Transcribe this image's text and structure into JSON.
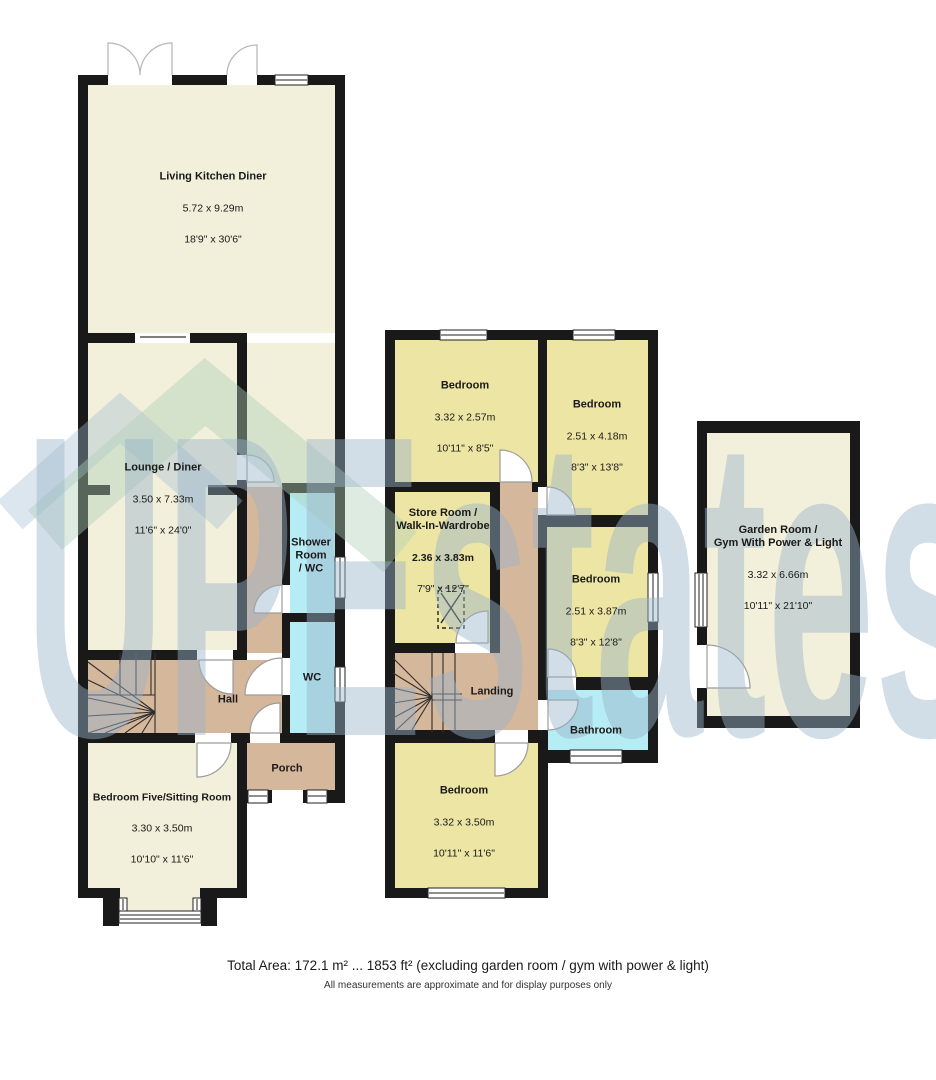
{
  "watermark": {
    "text": "UPEstates"
  },
  "colors": {
    "room_cream": "#f2efda",
    "room_yellow": "#ece5a4",
    "hall_tan": "#d5b79b",
    "wet_cyan": "#b6ecf4",
    "wall": "#191919",
    "watermark_text": "#9ab4cb",
    "watermark_roof_green": "#aed0b7",
    "watermark_roof_blue": "#a2bed6"
  },
  "floors": {
    "ground": {
      "rooms": {
        "living_kitchen_diner": {
          "name": "Living Kitchen Diner",
          "metric": "5.72 x 9.29m",
          "imperial": "18'9\" x 30'6\""
        },
        "lounge_diner": {
          "name": "Lounge / Diner",
          "metric": "3.50 x 7.33m",
          "imperial": "11'6\" x 24'0\""
        },
        "shower_room_wc": {
          "name": "Shower\nRoom\n/ WC"
        },
        "wc": {
          "name": "WC"
        },
        "hall": {
          "name": "Hall"
        },
        "porch": {
          "name": "Porch"
        },
        "bedroom_five": {
          "name": "Bedroom Five/Sitting Room",
          "metric": "3.30 x 3.50m",
          "imperial": "10'10\" x 11'6\""
        }
      }
    },
    "first": {
      "rooms": {
        "bedroom_front": {
          "name": "Bedroom",
          "metric": "3.32 x 2.57m",
          "imperial": "10'11\" x 8'5\""
        },
        "bedroom_right": {
          "name": "Bedroom",
          "metric": "2.51 x 4.18m",
          "imperial": "8'3\" x 13'8\""
        },
        "store_room": {
          "name": "Store Room /\nWalk-In-Wardrobe",
          "metric": "2.36 x 3.83m",
          "imperial": "7'9\" x 12'7\""
        },
        "bedroom_middle": {
          "name": "Bedroom",
          "metric": "2.51 x 3.87m",
          "imperial": "8'3\" x 12'8\""
        },
        "landing": {
          "name": "Landing"
        },
        "bathroom": {
          "name": "Bathroom"
        },
        "bedroom_back": {
          "name": "Bedroom",
          "metric": "3.32 x 3.50m",
          "imperial": "10'11\" x 11'6\""
        }
      }
    },
    "outbuilding": {
      "rooms": {
        "garden_room": {
          "name": "Garden Room /\nGym With Power & Light",
          "metric": "3.32 x 6.66m",
          "imperial": "10'11\" x 21'10\""
        }
      }
    }
  },
  "footer": {
    "total_area": "Total Area: 172.1 m² ... 1853 ft² (excluding garden room / gym with power & light)",
    "disclaimer": "All measurements are approximate and for display purposes only"
  }
}
